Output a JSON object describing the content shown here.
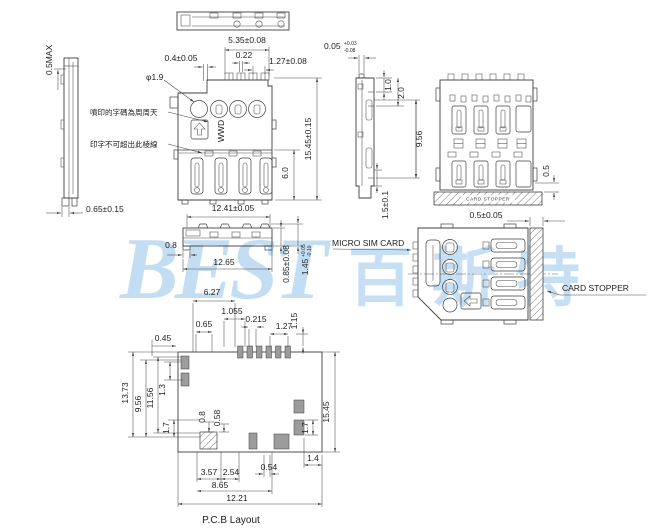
{
  "watermark": {
    "latin": "BEST",
    "cjk": "百斯特"
  },
  "side_left": {
    "max_note": "0.5MAX",
    "standoff": "0.65±0.15"
  },
  "notes": {
    "print_code": "噴印的字碼為周周天",
    "print_limit": "印字不可超出此棱線"
  },
  "front": {
    "group_width": "5.35±0.08",
    "step": "0.4±0.05",
    "slot": "0.22",
    "pitch": "1.27±0.08",
    "hole_dia": "φ1.9",
    "marking": "WWD",
    "height": "15.45±0.15",
    "lower_height": "6.0"
  },
  "side_right": {
    "lip": "0.05",
    "lip_tol_plus": "+0.03",
    "lip_tol_minus": "-0.08",
    "top_step": "1.0",
    "top_depth": "2.0",
    "body_depth": "9.56",
    "foot": "1.5±0.1"
  },
  "bottom": {
    "inner_width": "12.41±0.05",
    "tab": "0.8",
    "outer_width": "12.65",
    "wall": "0.85±0.08",
    "contact_height": "1.45",
    "contact_tol_plus": "+0.05",
    "contact_tol_minus": "-0.10"
  },
  "card": {
    "tip_gap": "0.5",
    "stopper_mark": "CARD STOPPER",
    "stopper_thickness": "0.5±0.05",
    "sim_label": "MICRO SIM CARD",
    "stopper_label": "CARD STOPPER"
  },
  "pcb": {
    "title": "P.C.B Layout",
    "w_group": "6.27",
    "w_1055": "1.055",
    "w_065": "0.65",
    "w_0215": "0.215",
    "w_127": "1.27",
    "h_115": "1.15",
    "w_045": "0.45",
    "h_1373": "13.73",
    "h_956": "9.56",
    "h_1156": "11.56",
    "h_13": "1.3",
    "h_17_left": "1.7",
    "w_08": "0.8",
    "w_058": "0.58",
    "h_1545": "15.45",
    "h_17_right": "1.7",
    "w_14": "1.4",
    "w_054": "0.54",
    "w_357": "3.57",
    "w_254": "2.54",
    "w_865": "8.65",
    "w_1221": "12.21"
  }
}
